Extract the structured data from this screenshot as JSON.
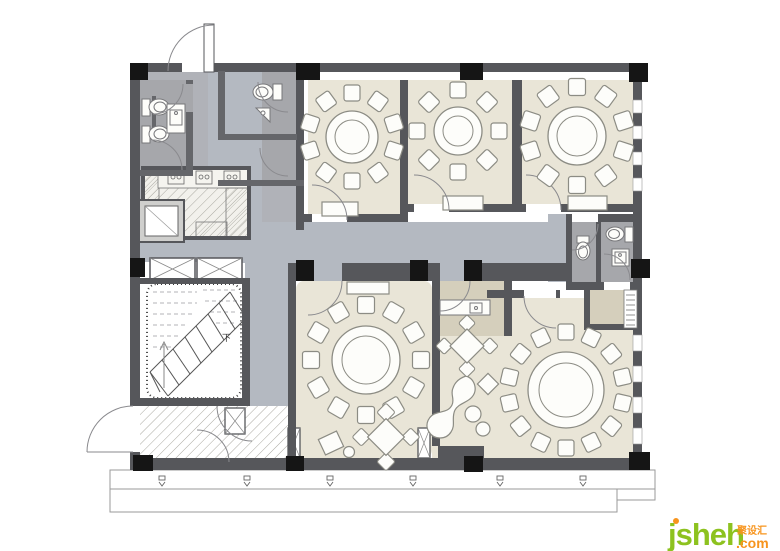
{
  "watermark": {
    "brand": "jsheh",
    "suffix": ".com",
    "chinese": "聚设汇"
  },
  "stairs": {
    "down_label": "下"
  },
  "colors": {
    "floor_room": "#e9e5d7",
    "floor_service": "#d5cfbc",
    "floor_corridor": "#b4b9c1",
    "floor_bath": "#a6a7ab",
    "service_base": "#b0b2b8",
    "wall": "#56575b",
    "inner_wall": "#65666a",
    "column": "#151515",
    "furniture_fill": "#fdfdfa",
    "furniture_stroke": "#8c8c84",
    "hatch_line": "#aaa9a1",
    "accent_green": "#8dc21f",
    "accent_orange": "#f7941d"
  },
  "furniture": {
    "round_tables": [
      {
        "room": "private-room-1",
        "cx": 352,
        "cy": 137,
        "table_r": 26,
        "inner_r": 17,
        "seats": 10,
        "seat_ring": 44,
        "seat": 16,
        "offset": -1.5708
      },
      {
        "room": "private-room-2",
        "cx": 458,
        "cy": 131,
        "table_r": 24,
        "inner_r": 15,
        "seats": 8,
        "seat_ring": 41,
        "seat": 16,
        "offset": -1.5708
      },
      {
        "room": "private-room-3",
        "cx": 577,
        "cy": 136,
        "table_r": 29,
        "inner_r": 20,
        "seats": 10,
        "seat_ring": 49,
        "seat": 17,
        "offset": -1.5708
      },
      {
        "room": "private-room-4",
        "cx": 366,
        "cy": 360,
        "table_r": 34,
        "inner_r": 24,
        "seats": 12,
        "seat_ring": 55,
        "seat": 17,
        "offset": -1.5708
      },
      {
        "room": "private-room-5",
        "cx": 566,
        "cy": 390,
        "table_r": 38,
        "inner_r": 27,
        "seats": 14,
        "seat_ring": 58,
        "seat": 16,
        "offset": -1.5708
      }
    ],
    "square_tables": [
      {
        "room": "private-room-4",
        "cx": 386,
        "cy": 437,
        "size": 26,
        "chair": 13
      },
      {
        "room": "lounge",
        "cx": 467,
        "cy": 346,
        "size": 24,
        "chair": 12
      }
    ]
  },
  "terrace": {
    "downlight_x": [
      162,
      247,
      330,
      413,
      500,
      583
    ]
  }
}
